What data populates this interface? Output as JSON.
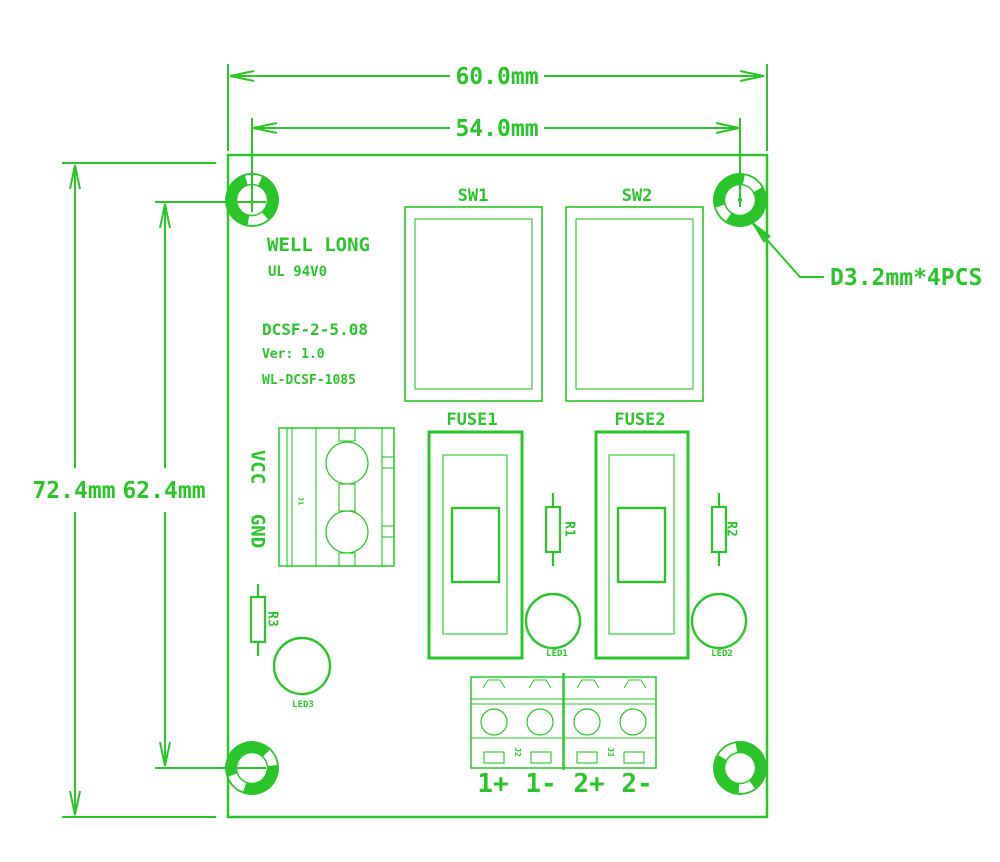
{
  "title": "PCB dimension drawing",
  "colors": {
    "line": "#2bc52b",
    "background": "#ffffff"
  },
  "dimensions": {
    "board_width": "60.0mm",
    "hole_span_width": "54.0mm",
    "board_height": "72.4mm",
    "hole_span_height": "62.4mm",
    "hole_note": "D3.2mm*4PCS"
  },
  "silkscreen": {
    "brand": "WELL LONG",
    "flammability": "UL 94V0",
    "model": "DCSF-2-5.08",
    "version": "Ver: 1.0",
    "part_number": "WL-DCSF-1085",
    "power_pos": "VCC",
    "power_neg": "GND"
  },
  "components": {
    "sw1": "SW1",
    "sw2": "SW2",
    "fuse1": "FUSE1",
    "fuse2": "FUSE2",
    "r1": "R1",
    "r2": "R2",
    "r3": "R3",
    "led1": "LED1",
    "led2": "LED2",
    "led3": "LED3",
    "j1": "J1",
    "j2": "J2",
    "j3": "J3"
  },
  "terminals": {
    "out1_pos": "1+",
    "out1_neg": "1-",
    "out2_pos": "2+",
    "out2_neg": "2-"
  }
}
